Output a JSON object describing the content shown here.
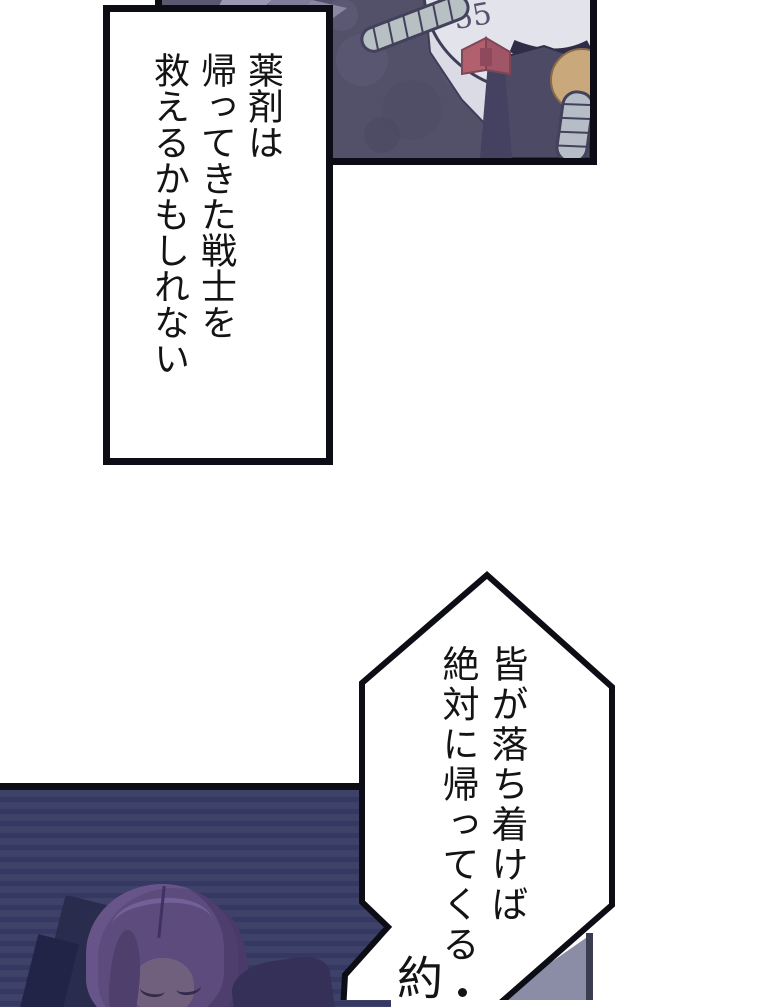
{
  "comic": {
    "bubble1": {
      "line1": "薬剤は",
      "line2": "帰ってきた戦士を",
      "line3": "救えるかもしれない"
    },
    "bubble2": {
      "line1": "皆が落ち着けば",
      "line2": "絶対に帰ってくる",
      "trailing": "約"
    },
    "head_marks": "55"
  },
  "colors": {
    "panel_border": "#0c0c14",
    "top_panel_bg": "#5a5871",
    "bottom_panel_bg": "#3e4168",
    "bottom_panel_stripe": "#353862",
    "bubble_fill": "#ffffff",
    "bubble_border": "#0d0d15",
    "text": "#141414",
    "bowtie_red": "#b25f6e",
    "robot_head": "#e3e3eb",
    "tube": "#b7c0c3",
    "vest": "#4c4a64",
    "tan_circle": "#c9a87c",
    "hair_purple": "#5c4b7c",
    "grey_fragment": "#8b8da6"
  }
}
